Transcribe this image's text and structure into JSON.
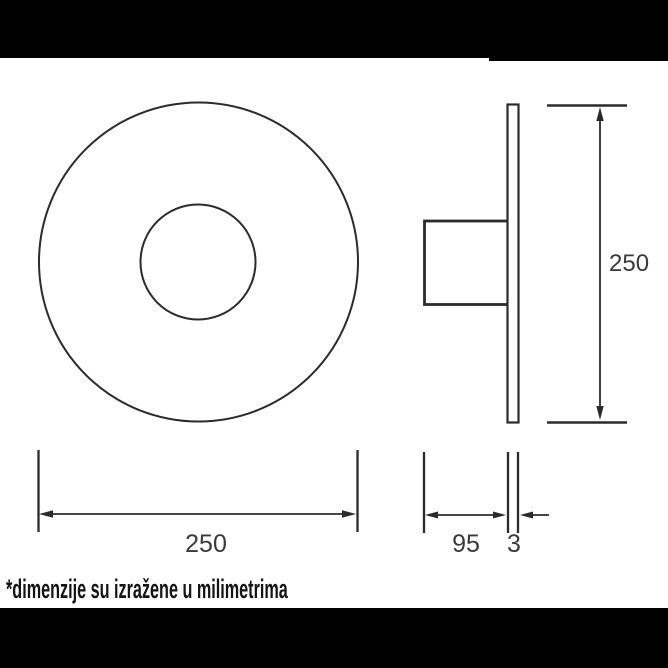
{
  "header": {
    "bar_color": "#000000"
  },
  "footer": {
    "bar_color": "#000000"
  },
  "drawing": {
    "kind": "technical-dimension-drawing",
    "line_color": "#2b2b2b",
    "label_color": "#3a3a3c",
    "views": {
      "front": {
        "label": "front-view-circular-plate"
      },
      "side": {
        "label": "side-view-plate-with-housing"
      }
    },
    "dimensions": {
      "front_width": "250",
      "side_depth": "95",
      "plate_thickness": "3",
      "side_height": "250"
    },
    "note": "*dimenzije su izražene u milimetrima"
  }
}
